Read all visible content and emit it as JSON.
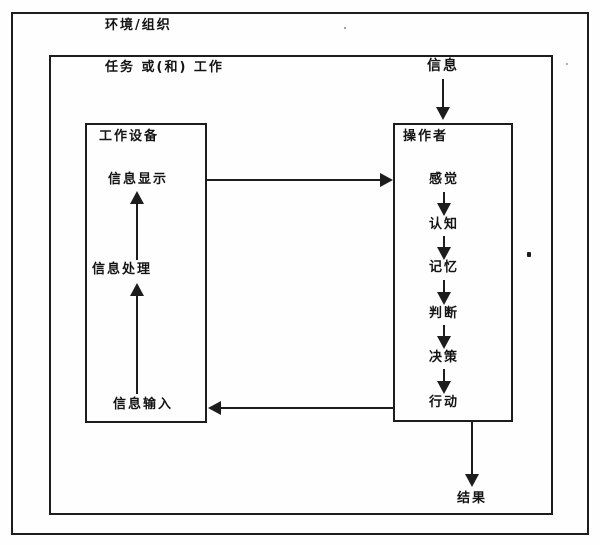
{
  "diagram": {
    "environment_label": "环境/组织",
    "task_label": "任务 或(和) 工作",
    "input_label": "信息",
    "result_label": "结果",
    "equipment": {
      "title": "工作设备",
      "items": [
        "信息显示",
        "信息处理",
        "信息输入"
      ]
    },
    "operator": {
      "title": "操作者",
      "items": [
        "感觉",
        "认知",
        "记忆",
        "判断",
        "决策",
        "行动"
      ]
    },
    "colors": {
      "line": "#1d1d1d",
      "background": "#fefefe",
      "text": "#141414"
    }
  }
}
